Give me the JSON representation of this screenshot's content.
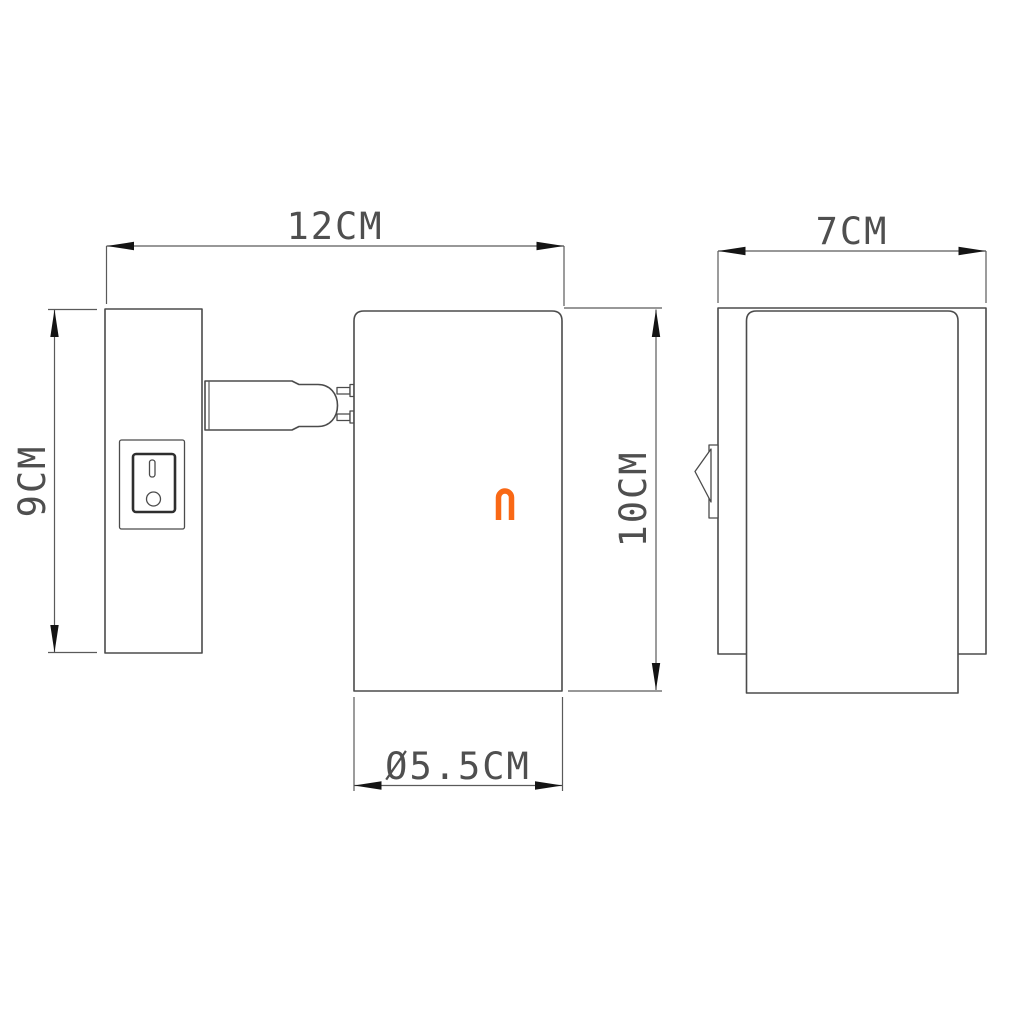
{
  "drawing": {
    "background": "#ffffff",
    "line_color": "#4b4b4b",
    "dim_line_color": "#5a5a5a",
    "arrow_color": "#141414",
    "text_color": "#4f4f4f",
    "logo": {
      "glyph": "n",
      "color": "#f96815"
    },
    "front_view": {
      "dimensions": {
        "overall_width": "12CM",
        "backplate_height": "9CM",
        "head_height": "10CM",
        "head_diameter": "Ø5.5CM"
      }
    },
    "side_view": {
      "dimensions": {
        "depth": "7CM"
      }
    }
  }
}
